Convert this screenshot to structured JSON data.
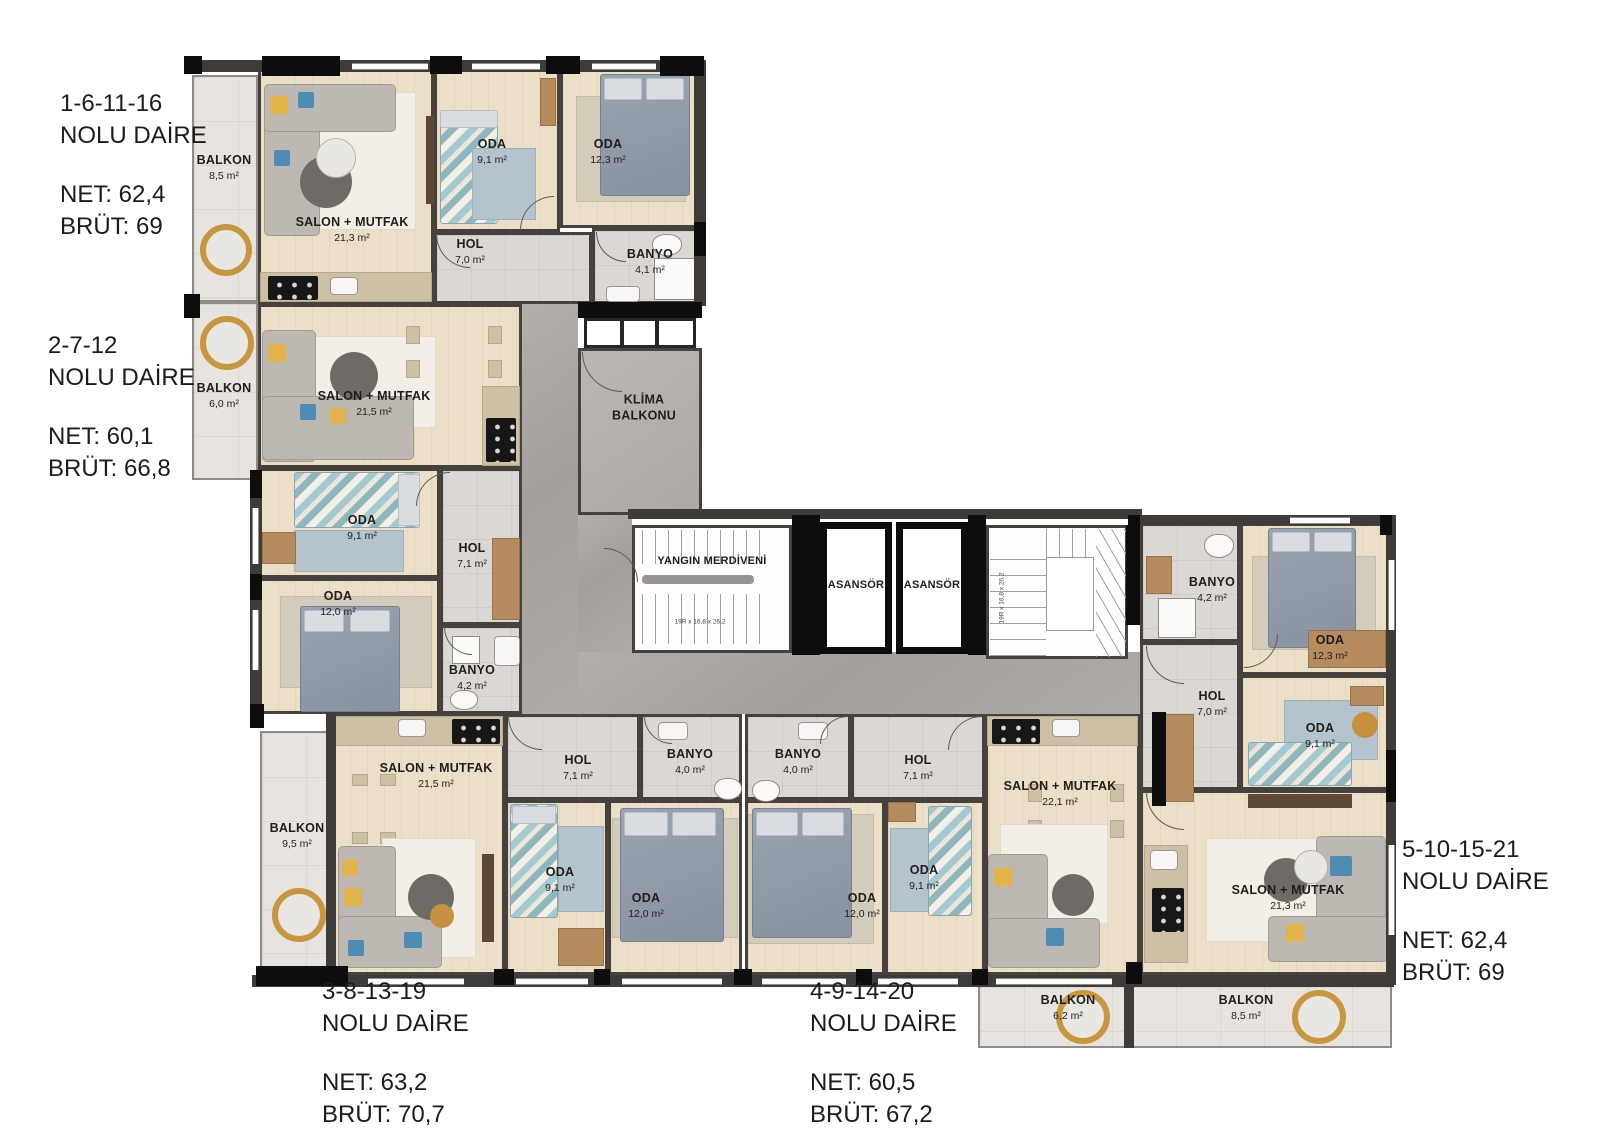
{
  "apartments": [
    {
      "nums": "1-6-11-16",
      "sub": "NOLU DAİRE",
      "net": "NET: 62,4",
      "brut": "BRÜT: 69",
      "rooms": [
        {
          "name": "BALKON",
          "area": "8,5 m²"
        },
        {
          "name": "SALON + MUTFAK",
          "area": "21,3 m²"
        },
        {
          "name": "ODA",
          "area": "9,1 m²"
        },
        {
          "name": "ODA",
          "area": "12,3 m²"
        },
        {
          "name": "HOL",
          "area": "7,0 m²"
        },
        {
          "name": "BANYO",
          "area": "4,1 m²"
        }
      ]
    },
    {
      "nums": "2-7-12",
      "sub": "NOLU DAİRE",
      "net": "NET: 60,1",
      "brut": "BRÜT: 66,8",
      "rooms": [
        {
          "name": "BALKON",
          "area": "6,0 m²"
        },
        {
          "name": "SALON + MUTFAK",
          "area": "21,5 m²"
        },
        {
          "name": "ODA",
          "area": "9,1 m²"
        },
        {
          "name": "ODA",
          "area": "12,0 m²"
        },
        {
          "name": "HOL",
          "area": "7,1 m²"
        },
        {
          "name": "BANYO",
          "area": "4,2 m²"
        }
      ]
    },
    {
      "nums": "3-8-13-19",
      "sub": "NOLU DAİRE",
      "net": "NET: 63,2",
      "brut": "BRÜT: 70,7",
      "rooms": [
        {
          "name": "BALKON",
          "area": "9,5 m²"
        },
        {
          "name": "SALON + MUTFAK",
          "area": "21,5 m²"
        },
        {
          "name": "HOL",
          "area": "7,1 m²"
        },
        {
          "name": "BANYO",
          "area": "4,0 m²"
        },
        {
          "name": "ODA",
          "area": "9,1 m²"
        },
        {
          "name": "ODA",
          "area": "12,0 m²"
        }
      ]
    },
    {
      "nums": "4-9-14-20",
      "sub": "NOLU DAİRE",
      "net": "NET: 60,5",
      "brut": "BRÜT: 67,2",
      "rooms": [
        {
          "name": "BANYO",
          "area": "4,0 m²"
        },
        {
          "name": "HOL",
          "area": "7,1 m²"
        },
        {
          "name": "ODA",
          "area": "12,0 m²"
        },
        {
          "name": "ODA",
          "area": "9,1 m²"
        },
        {
          "name": "SALON + MUTFAK",
          "area": "22,1 m²"
        },
        {
          "name": "BALKON",
          "area": "6,2 m²"
        }
      ]
    },
    {
      "nums": "5-10-15-21",
      "sub": "NOLU DAİRE",
      "net": "NET: 62,4",
      "brut": "BRÜT: 69",
      "rooms": [
        {
          "name": "BANYO",
          "area": "4,2 m²"
        },
        {
          "name": "ODA",
          "area": "12,3 m²"
        },
        {
          "name": "HOL",
          "area": "7,0 m²"
        },
        {
          "name": "ODA",
          "area": "9,1 m²"
        },
        {
          "name": "SALON + MUTFAK",
          "area": "21,3 m²"
        },
        {
          "name": "BALKON",
          "area": "8,5 m²"
        }
      ]
    }
  ],
  "core": {
    "fire_stairs": "YANGIN MERDİVENİ",
    "elevator_1": "ASANSÖR",
    "elevator_2": "ASANSÖR",
    "klima": "KLİMA\nBALKONU",
    "stair_spec": "19R x 16,8 x 26,2"
  },
  "palette": {
    "wall": "#3e3b38",
    "wood_floor": "#ecdfc8",
    "tile_floor": "#dbd8d3",
    "corridor": "#a9a6a1",
    "balcony": "#e7e4df",
    "accent_yellow": "#e3b44c",
    "accent_blue": "#4e8cb4"
  }
}
